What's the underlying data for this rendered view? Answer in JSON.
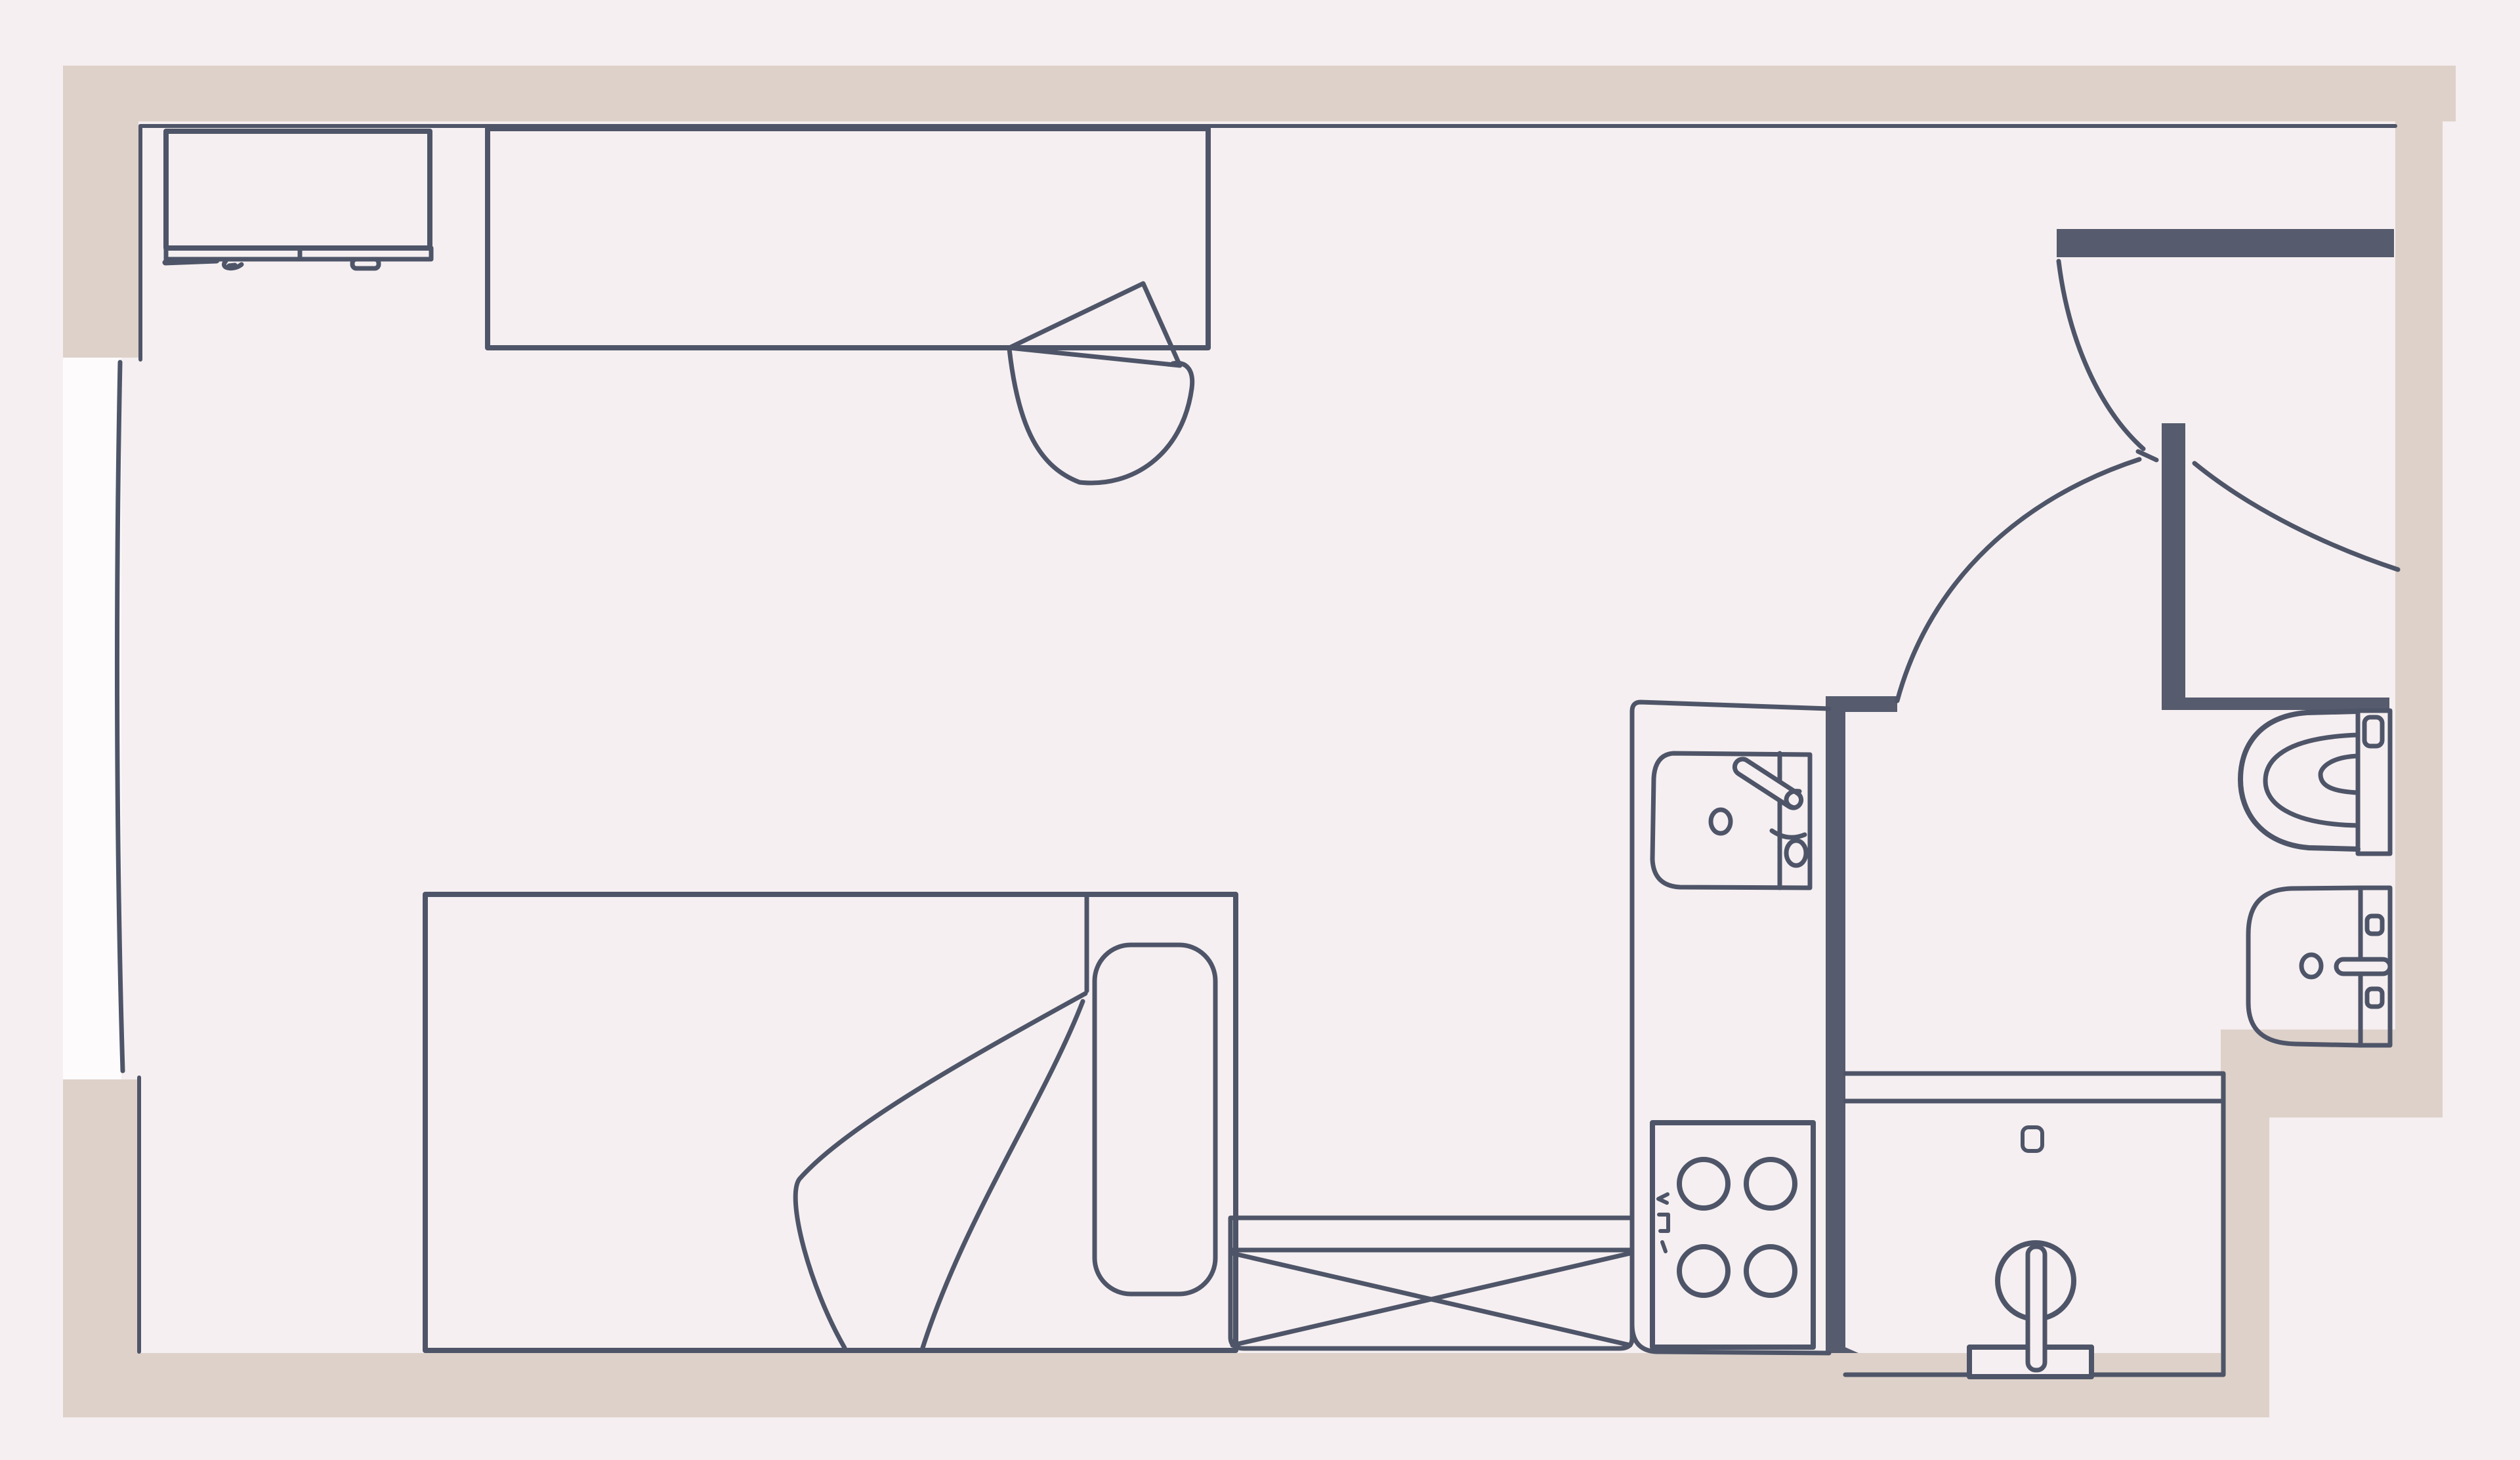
{
  "meta": {
    "title": "Studio apartment floor plan",
    "type": "floor-plan-drawing"
  },
  "colors": {
    "page": "#f4eef0",
    "floor": "#f5eff1",
    "wall-beige": "#ddd1c9",
    "wall-dark": "#565b6d",
    "ink": "#4f5568",
    "window-white": "#fdfbfc"
  },
  "fixtures": [
    {
      "id": "tv-unit",
      "label": "TV / media unit"
    },
    {
      "id": "desk",
      "label": "Desk"
    },
    {
      "id": "desk-chair",
      "label": "Desk chair"
    },
    {
      "id": "window",
      "label": "Window (left wall)"
    },
    {
      "id": "bed",
      "label": "Bed with pillow and folded blanket"
    },
    {
      "id": "bench",
      "label": "Cross-marked bench / storage"
    },
    {
      "id": "kitchen-counter",
      "label": "Kitchen counter"
    },
    {
      "id": "kitchen-sink",
      "label": "Kitchen sink with faucet"
    },
    {
      "id": "stove",
      "label": "Four-burner stove"
    },
    {
      "id": "entry-door",
      "label": "Entry door with swing arc"
    },
    {
      "id": "bathroom-door",
      "label": "Bathroom door with swing arc"
    },
    {
      "id": "toilet",
      "label": "Toilet with cistern"
    },
    {
      "id": "washbasin",
      "label": "Wash basin"
    },
    {
      "id": "shower",
      "label": "Shower with hand shower"
    }
  ]
}
